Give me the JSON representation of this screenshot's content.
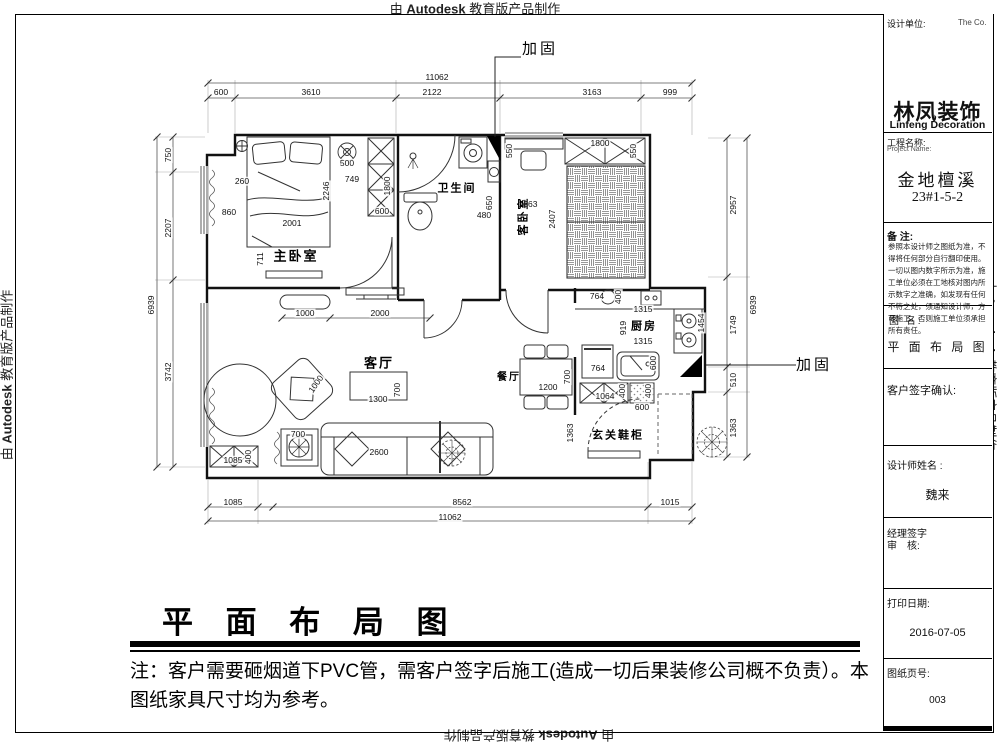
{
  "watermark": {
    "prefix": "由 ",
    "brand": "Autodesk",
    "suffix": " 教育版产品制作"
  },
  "sheet": {
    "title": "平 面 布 局 图",
    "note": "注：客户需要砸烟道下PVC管，需客户签字后施工(造成一切后果装修公司概不负责）。本图纸家具尺寸均为参考。"
  },
  "title_block": {
    "design_unit_label": "设计单位:",
    "company_en_small": "The Co.",
    "logo_name_cn": "林凤装饰",
    "logo_name_en": "Linfeng Decoration",
    "project_label_cn": "工程名称:",
    "project_label_en": "Project Name:",
    "project_name": "金地檀溪",
    "project_no": "23#1-5-2",
    "remarks_label": "备 注:",
    "remarks_text": "参照本设计师之图纸为准，不得将任何部分自行翻印使用。一切以图内数字所示为准，施工单位必须在工地核对图内所示数字之准确，如发现有任何不符之处，须通知设计师，方可施工，否则施工单位须承担所有责任。",
    "drawing_name_label": "图 名:",
    "drawing_name": "平 面 布 局 图",
    "client_sign_label": "客户签字确认:",
    "designer_label": "设计师姓名 :",
    "designer_name": "魏来",
    "manager_sign_label": "经理签字",
    "review_label": "审　核:",
    "print_date_label": "打印日期:",
    "print_date": "2016-07-05",
    "page_no_label": "图纸页号:",
    "page_no": "003"
  },
  "colors": {
    "logo_orange": "#F97316",
    "logo_red": "#DC2626",
    "logo_yellow": "#FDBA2D",
    "line": "#111111"
  },
  "plan": {
    "rooms": [
      {
        "t": "主卧室",
        "x": 296,
        "y": 256,
        "fs": 13
      },
      {
        "t": "卫生间",
        "x": 457,
        "y": 189,
        "fs": 11
      },
      {
        "t": "客卧室",
        "x": 524,
        "y": 216,
        "fs": 11,
        "r": -90
      },
      {
        "t": "厨房",
        "x": 644,
        "y": 327,
        "fs": 11
      },
      {
        "t": "客厅",
        "x": 379,
        "y": 363,
        "fs": 13
      },
      {
        "t": "餐厅",
        "x": 509,
        "y": 378,
        "fs": 10
      },
      {
        "t": "玄关鞋柜",
        "x": 618,
        "y": 436,
        "fs": 11
      }
    ],
    "callouts": [
      {
        "t": "加固",
        "x": 540,
        "y": 49
      },
      {
        "t": "加固",
        "x": 814,
        "y": 365
      }
    ],
    "dimensions": [
      {
        "t": "11062",
        "x": 437,
        "y": 77
      },
      {
        "t": "600",
        "x": 221,
        "y": 92
      },
      {
        "t": "3610",
        "x": 311,
        "y": 92
      },
      {
        "t": "2122",
        "x": 432,
        "y": 92
      },
      {
        "t": "3163",
        "x": 592,
        "y": 92
      },
      {
        "t": "999",
        "x": 670,
        "y": 92
      },
      {
        "t": "1085",
        "x": 233,
        "y": 502
      },
      {
        "t": "8562",
        "x": 462,
        "y": 502
      },
      {
        "t": "1015",
        "x": 670,
        "y": 502
      },
      {
        "t": "11062",
        "x": 450,
        "y": 517
      },
      {
        "t": "6939",
        "x": 151,
        "y": 305,
        "r": -90
      },
      {
        "t": "750",
        "x": 168,
        "y": 155,
        "r": -90
      },
      {
        "t": "2207",
        "x": 168,
        "y": 228,
        "r": -90
      },
      {
        "t": "3742",
        "x": 168,
        "y": 372,
        "r": -90
      },
      {
        "t": "6939",
        "x": 753,
        "y": 305,
        "r": -90
      },
      {
        "t": "2957",
        "x": 733,
        "y": 205,
        "r": -90
      },
      {
        "t": "1749",
        "x": 733,
        "y": 325,
        "r": -90
      },
      {
        "t": "510",
        "x": 733,
        "y": 380,
        "r": -90
      },
      {
        "t": "1363",
        "x": 733,
        "y": 428,
        "r": -90
      },
      {
        "t": "260",
        "x": 242,
        "y": 181
      },
      {
        "t": "860",
        "x": 229,
        "y": 212
      },
      {
        "t": "2001",
        "x": 292,
        "y": 223
      },
      {
        "t": "2246",
        "x": 326,
        "y": 191,
        "r": -90
      },
      {
        "t": "711",
        "x": 260,
        "y": 259,
        "r": -90
      },
      {
        "t": "500",
        "x": 347,
        "y": 163
      },
      {
        "t": "749",
        "x": 352,
        "y": 179
      },
      {
        "t": "1800",
        "x": 387,
        "y": 186,
        "r": -90
      },
      {
        "t": "600",
        "x": 382,
        "y": 211
      },
      {
        "t": "650",
        "x": 489,
        "y": 203,
        "r": -90
      },
      {
        "t": "480",
        "x": 484,
        "y": 215
      },
      {
        "t": "550",
        "x": 509,
        "y": 151,
        "r": -90
      },
      {
        "t": "1363",
        "x": 528,
        "y": 204
      },
      {
        "t": "2407",
        "x": 552,
        "y": 219,
        "r": -90
      },
      {
        "t": "1800",
        "x": 600,
        "y": 143
      },
      {
        "t": "550",
        "x": 633,
        "y": 151,
        "r": -90
      },
      {
        "t": "1000",
        "x": 305,
        "y": 313
      },
      {
        "t": "2000",
        "x": 380,
        "y": 313
      },
      {
        "t": "1300",
        "x": 378,
        "y": 399
      },
      {
        "t": "700",
        "x": 397,
        "y": 390,
        "r": -90
      },
      {
        "t": "1000",
        "x": 316,
        "y": 384,
        "r": -55
      },
      {
        "t": "700",
        "x": 298,
        "y": 434
      },
      {
        "t": "2600",
        "x": 379,
        "y": 452
      },
      {
        "t": "1085",
        "x": 233,
        "y": 460
      },
      {
        "t": "400",
        "x": 248,
        "y": 457,
        "r": -90
      },
      {
        "t": "1200",
        "x": 548,
        "y": 387
      },
      {
        "t": "700",
        "x": 567,
        "y": 377,
        "r": -90
      },
      {
        "t": "764",
        "x": 597,
        "y": 296
      },
      {
        "t": "400",
        "x": 618,
        "y": 297,
        "r": -90
      },
      {
        "t": "1315",
        "x": 643,
        "y": 309
      },
      {
        "t": "919",
        "x": 623,
        "y": 328,
        "r": -90
      },
      {
        "t": "1315",
        "x": 643,
        "y": 341
      },
      {
        "t": "1454",
        "x": 701,
        "y": 323,
        "r": -90
      },
      {
        "t": "764",
        "x": 598,
        "y": 368
      },
      {
        "t": "600",
        "x": 653,
        "y": 363,
        "r": -90
      },
      {
        "t": "1064",
        "x": 605,
        "y": 396
      },
      {
        "t": "400",
        "x": 622,
        "y": 391,
        "r": -90
      },
      {
        "t": "400",
        "x": 648,
        "y": 391,
        "r": -90
      },
      {
        "t": "600",
        "x": 642,
        "y": 407
      },
      {
        "t": "1363",
        "x": 570,
        "y": 433,
        "r": -90
      }
    ]
  }
}
